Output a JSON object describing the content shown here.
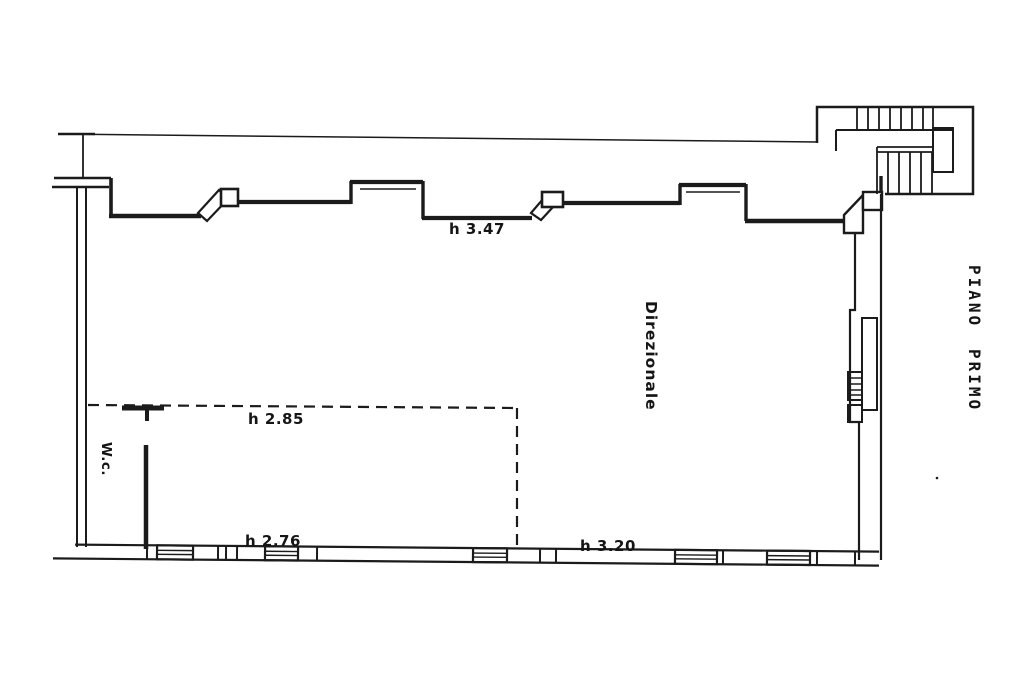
{
  "colors": {
    "background": "#ffffff",
    "ink": "#1b1b1b"
  },
  "floor_plan": {
    "floor_title": {
      "line1": "PIANO",
      "line2": "PRIMO"
    },
    "room_label": "Direzionale",
    "wc_label": "W.c.",
    "height_annotations": {
      "north_wall": "h 3.47",
      "wc_dropped_ceiling": "h 2.85",
      "south_wall_west": "h 2.76",
      "south_wall_east": "h 3.20"
    }
  }
}
